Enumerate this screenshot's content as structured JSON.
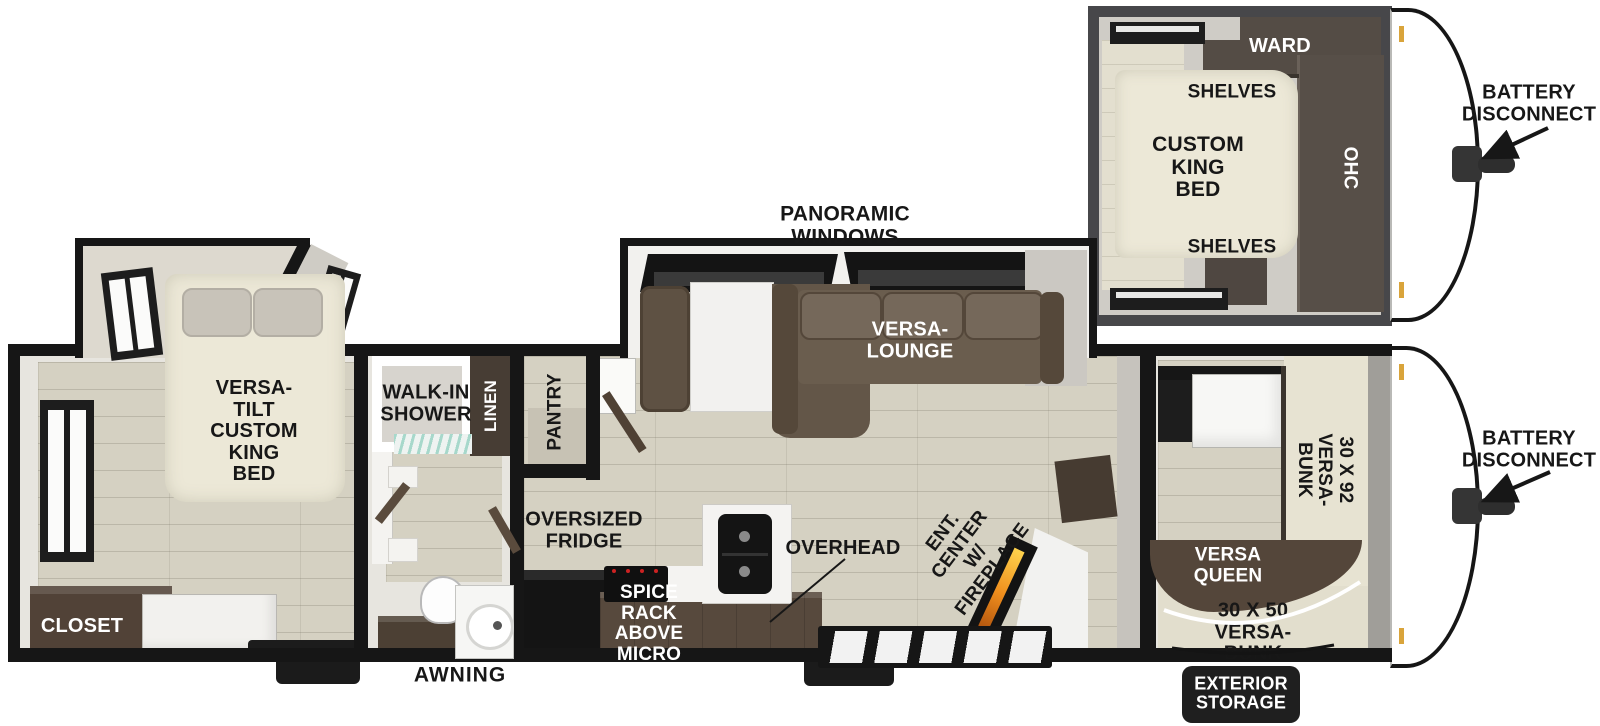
{
  "title": "Travel trailer floor plan with alternate front bedroom inset",
  "colors": {
    "wall_black": "#161616",
    "inset_wall_gray": "#47474a",
    "floor_wood": "#d5d1c2",
    "bed_cream": "#ece8d7",
    "sofa_brown": "#6a5d4e",
    "cabinet_brown": "#574f48",
    "counter_brown": "#57493d",
    "closet_brown": "#514237",
    "queen_brown": "#54463a",
    "flame_orange": "#ef8e1d",
    "shower_teal": "#a7d8cb",
    "clearance_light_yellow": "#d9a43b",
    "label_black": "#171717",
    "label_white": "#ffffff"
  },
  "inset": {
    "labels": {
      "ward": "WARD",
      "shelves_top": "SHELVES",
      "custom_king_bed": "CUSTOM\nKING BED",
      "ohc": "OHC",
      "shelves_bottom": "SHELVES",
      "battery_disconnect": "BATTERY\nDISCONNECT"
    }
  },
  "main": {
    "labels": {
      "panoramic_windows": "PANORAMIC WINDOWS",
      "versa_lounge": "VERSA-LOUNGE",
      "versa_tilt_king": "VERSA-TILT\nCUSTOM\nKING BED",
      "closet": "CLOSET",
      "walk_in_shower": "WALK-IN\nSHOWER",
      "linen": "LINEN",
      "pantry": "PANTRY",
      "oversized_fridge": "OVERSIZED\nFRIDGE",
      "spice_rack": "SPICE RACK\nABOVE MICRO",
      "overhead": "OVERHEAD",
      "ent_center": "ENT. CENTER\nW/ FIREPLACE",
      "bunk_30x92": "30 X 92\nVERSA-BUNK",
      "versa_queen": "VERSA\nQUEEN",
      "bunk_30x50": "30 X 50\nVERSA-BUNK",
      "exterior_storage": "EXTERIOR\nSTORAGE",
      "battery_disconnect": "BATTERY\nDISCONNECT",
      "awning": "AWNING"
    }
  }
}
